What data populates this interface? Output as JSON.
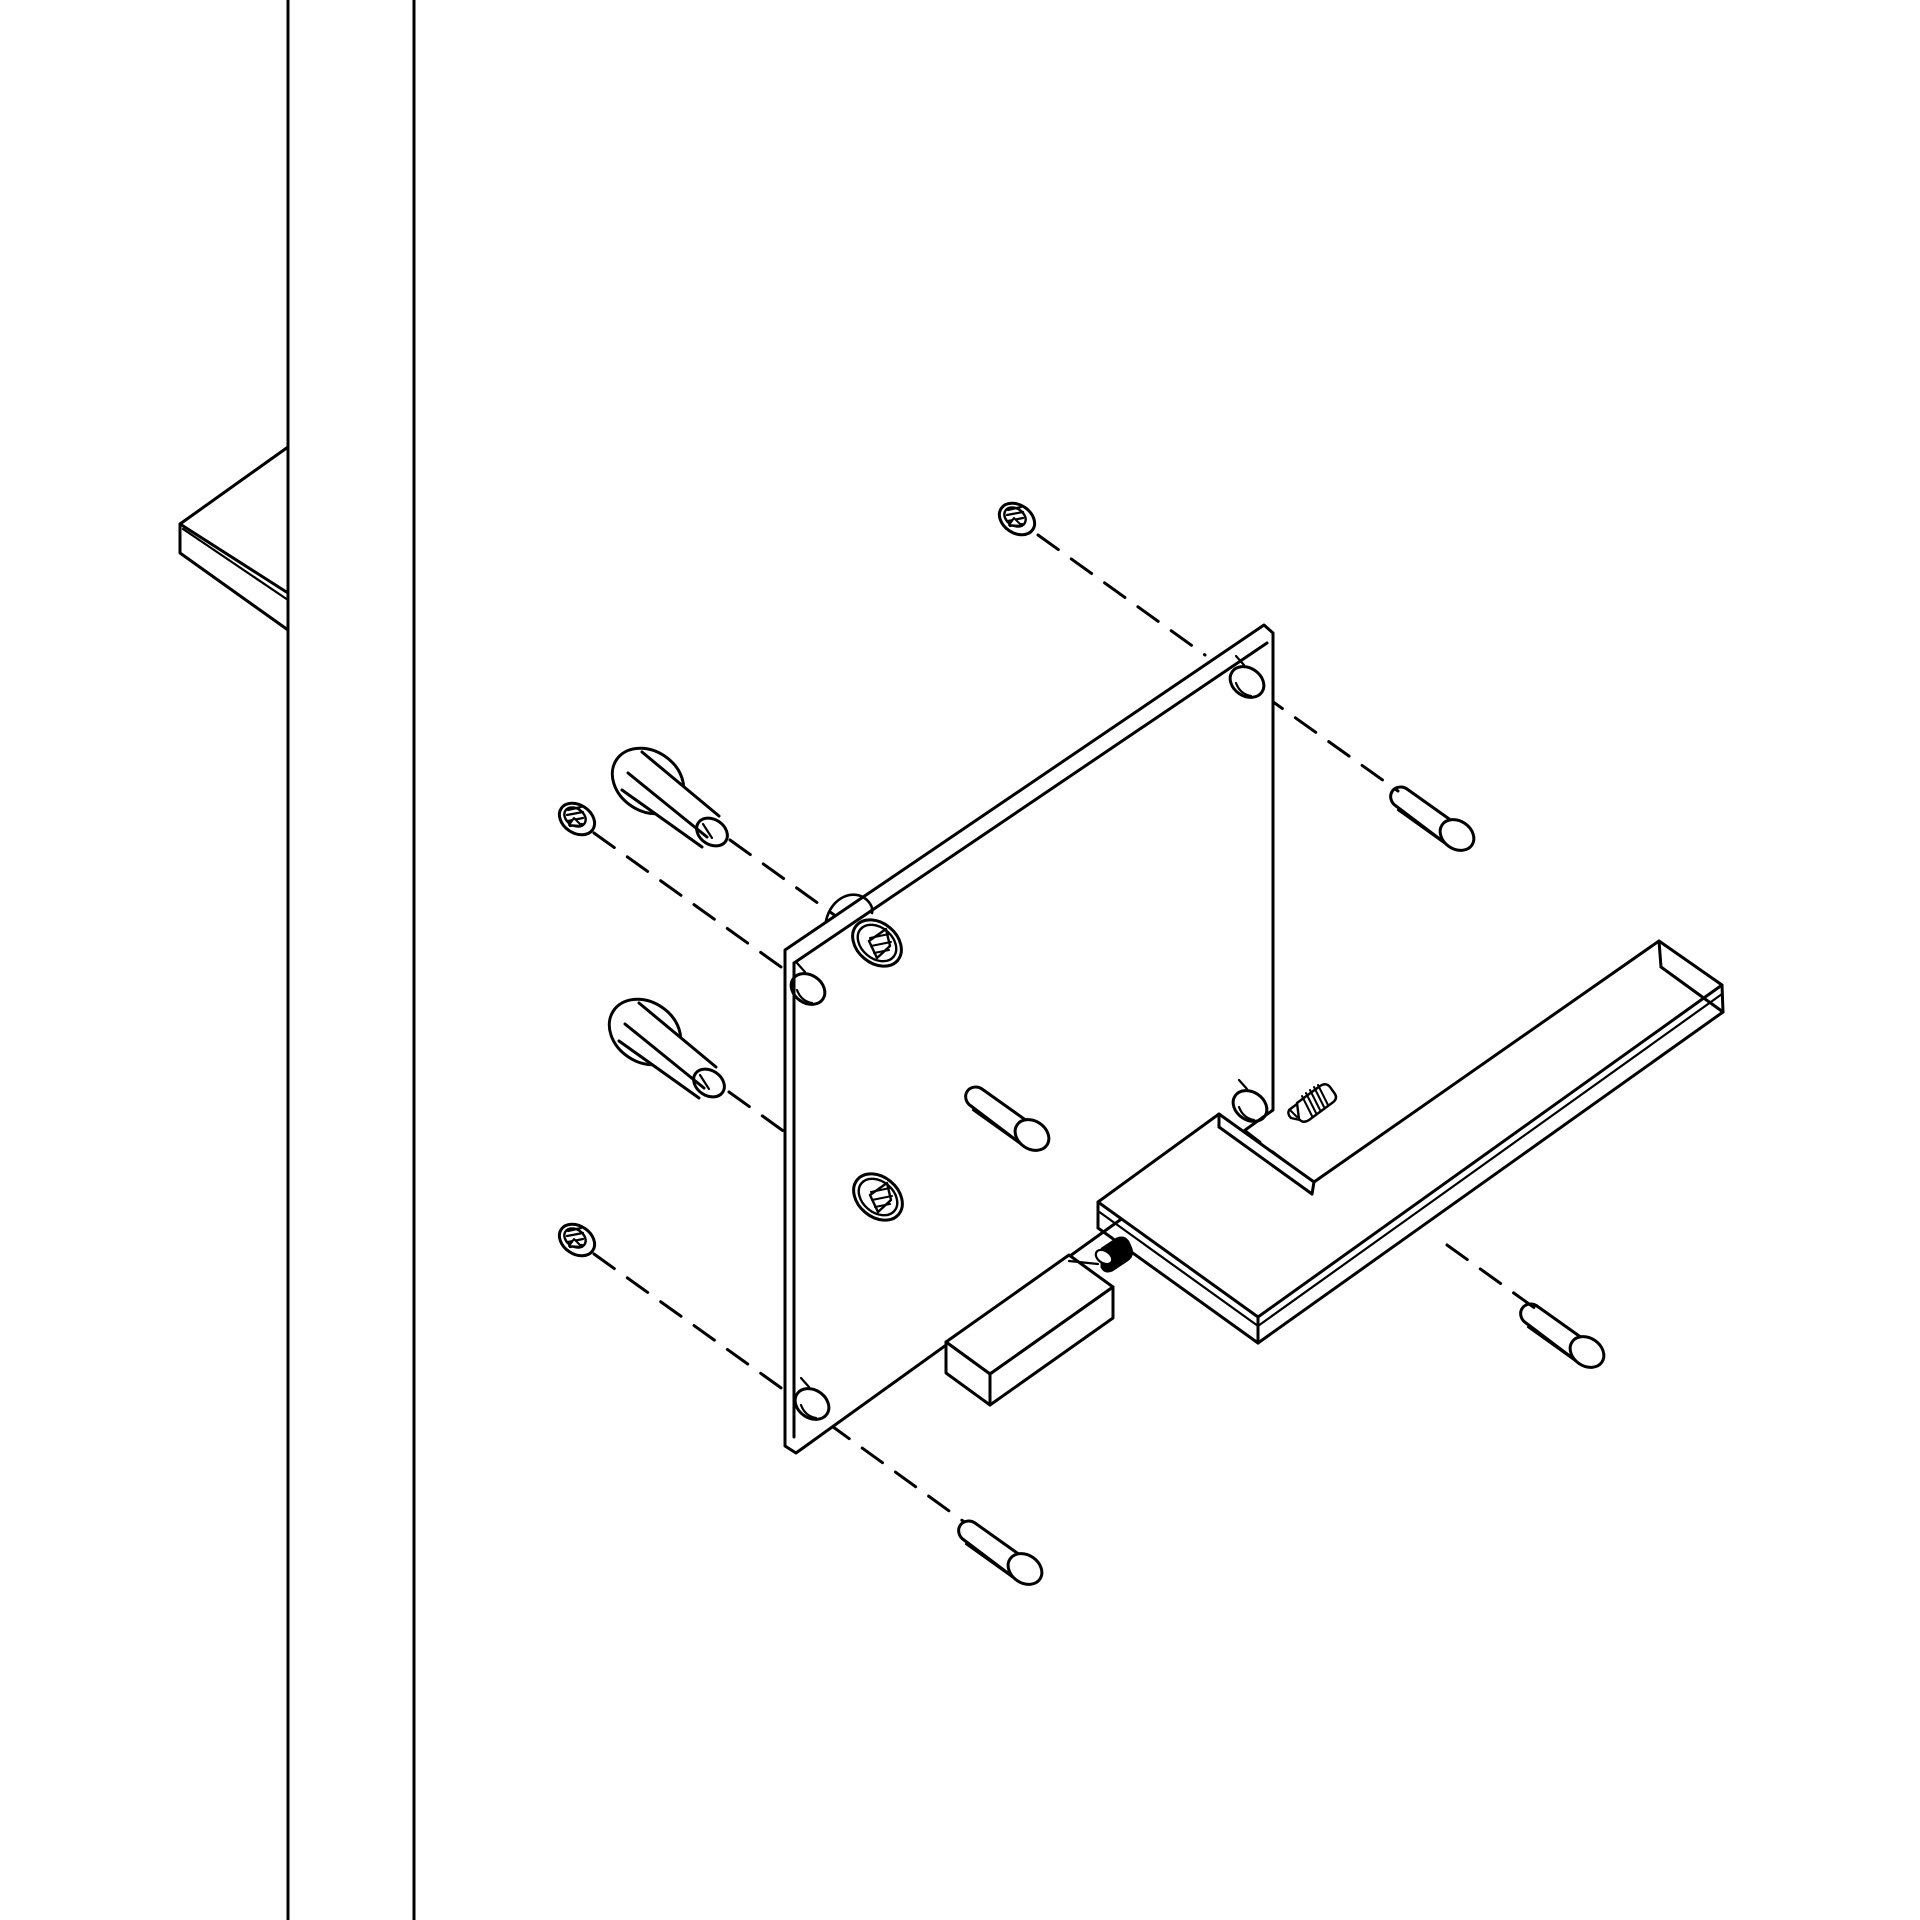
{
  "canvas": {
    "width": 1920,
    "height": 1920,
    "background_color": "#ffffff",
    "line_color": "#000000",
    "stroke_width": 3,
    "detail_stroke_width": 2.4,
    "dash_pattern": "25 16"
  },
  "diagram": {
    "kind": "exploded-isometric-line-drawing",
    "subject": "door-lever-handle-mounting-kit"
  },
  "parts": [
    {
      "name": "door-edge",
      "items": [
        {
          "t": "p",
          "d": "M 288 0 L 288 1920"
        },
        {
          "t": "p",
          "d": "M 414 0 L 414 1920"
        }
      ]
    },
    {
      "name": "strike-plate-corner",
      "items": [
        {
          "t": "p",
          "d": "M 288 447 L 180 524 L 180 553 L 288 630"
        },
        {
          "t": "p",
          "d": "M 180 524 L 288 593"
        },
        {
          "t": "p",
          "d": "M 183 529 L 288 600",
          "w": 2.2
        }
      ]
    },
    {
      "name": "dashed-assembly-axes",
      "dashed": true,
      "items": [
        {
          "t": "p",
          "d": "M 1038 535 L 1205 655"
        },
        {
          "t": "p",
          "d": "M 1262 694 L 1398 791"
        },
        {
          "t": "p",
          "d": "M 730 840 L 858 932"
        },
        {
          "t": "p",
          "d": "M 594 833 L 795 977"
        },
        {
          "t": "p",
          "d": "M 824 1003 L 968 1107"
        },
        {
          "t": "p",
          "d": "M 729 1092 L 860 1186"
        },
        {
          "t": "p",
          "d": "M 896 1211 L 988 1277"
        },
        {
          "t": "p",
          "d": "M 594 1254 L 798 1400"
        },
        {
          "t": "p",
          "d": "M 829 1424 L 963 1521"
        },
        {
          "t": "p",
          "d": "M 1240 1127 L 1312 1182"
        },
        {
          "t": "p",
          "d": "M 1447 1245 L 1543 1314"
        },
        {
          "t": "p",
          "d": "M 1133 1111 L 1162 1133"
        }
      ]
    },
    {
      "name": "back-plate",
      "items": [
        {
          "t": "p",
          "d": "M 785 950 L 1264 625 L 1273 633 L 1273 1110 L 796 1453 L 785 1446 Z",
          "fill": "#ffffff"
        },
        {
          "t": "p",
          "d": "M 794 963 L 1267 643"
        },
        {
          "t": "p",
          "d": "M 794 963 L 794 1437"
        },
        {
          "t": "p",
          "d": "M 826 921 C 831 897 854 888 867 900 C 872 905 873 909 872 913",
          "w": 2.6
        }
      ]
    },
    {
      "name": "plate-corner-hole-top-left",
      "items": [
        {
          "t": "e",
          "cx": 808,
          "cy": 989,
          "rx": 14,
          "ry": 18,
          "rot": -56
        },
        {
          "t": "p",
          "d": "M 797 990 Q 801 1001 812 1003",
          "w": 2.2
        },
        {
          "t": "p",
          "d": "M 805 972 L 797 963",
          "w": 2.2
        }
      ]
    },
    {
      "name": "plate-corner-hole-top-right",
      "items": [
        {
          "t": "e",
          "cx": 1247,
          "cy": 682,
          "rx": 14,
          "ry": 18,
          "rot": -56
        },
        {
          "t": "p",
          "d": "M 1236 683 Q 1240 694 1251 696",
          "w": 2.2
        },
        {
          "t": "p",
          "d": "M 1244 665 L 1236 656",
          "w": 2.2
        }
      ]
    },
    {
      "name": "plate-corner-hole-bottom-left",
      "items": [
        {
          "t": "e",
          "cx": 812,
          "cy": 1404,
          "rx": 14,
          "ry": 18,
          "rot": -56
        },
        {
          "t": "p",
          "d": "M 801 1405 Q 805 1416 816 1418",
          "w": 2.2
        },
        {
          "t": "p",
          "d": "M 809 1387 L 801 1378",
          "w": 2.2
        }
      ]
    },
    {
      "name": "plate-corner-hole-bottom-right",
      "items": [
        {
          "t": "e",
          "cx": 1250,
          "cy": 1106,
          "rx": 14,
          "ry": 18,
          "rot": -56
        },
        {
          "t": "p",
          "d": "M 1239 1107 Q 1243 1118 1254 1120",
          "w": 2.2
        },
        {
          "t": "p",
          "d": "M 1247 1089 L 1239 1080",
          "w": 2.2
        }
      ]
    },
    {
      "name": "plate-square-socket-upper",
      "items": [
        {
          "t": "e",
          "cx": 877,
          "cy": 943,
          "rx": 20,
          "ry": 27,
          "rot": -50
        },
        {
          "t": "e",
          "cx": 877,
          "cy": 943,
          "rx": 15.5,
          "ry": 21.5,
          "rot": -50,
          "w": 2.4
        },
        {
          "t": "p",
          "d": "M 886 929 L 869 941 L 877 958 L 890 946 Z",
          "w": 2.4
        },
        {
          "t": "p",
          "d": "M 870 938 L 889 934",
          "w": 2
        },
        {
          "t": "p",
          "d": "M 871 946 L 891 942",
          "w": 2
        },
        {
          "t": "p",
          "d": "M 874 953 L 889 950",
          "w": 2
        }
      ]
    },
    {
      "name": "plate-square-socket-lower",
      "items": [
        {
          "t": "e",
          "cx": 878,
          "cy": 1197,
          "rx": 20,
          "ry": 27,
          "rot": -50
        },
        {
          "t": "e",
          "cx": 878,
          "cy": 1197,
          "rx": 15.5,
          "ry": 21.5,
          "rot": -50,
          "w": 2.4
        },
        {
          "t": "p",
          "d": "M 887 1183 L 870 1195 L 878 1212 L 891 1200 Z",
          "w": 2.4
        },
        {
          "t": "p",
          "d": "M 871 1192 L 890 1188",
          "w": 2
        },
        {
          "t": "p",
          "d": "M 872 1200 L 892 1196",
          "w": 2
        },
        {
          "t": "p",
          "d": "M 875 1207 L 890 1204",
          "w": 2
        }
      ]
    },
    {
      "name": "flat-head-screw-top",
      "items": [
        {
          "t": "e",
          "cx": 1017,
          "cy": 519,
          "rx": 14,
          "ry": 19,
          "rot": -56,
          "fill": "#ffffff"
        },
        {
          "t": "e",
          "cx": 1015,
          "cy": 517,
          "rx": 8.5,
          "ry": 11.5,
          "rot": -56,
          "w": 2.4
        },
        {
          "t": "p",
          "d": "M 1008 510 L 1021 507",
          "w": 2.2
        },
        {
          "t": "p",
          "d": "M 1007 515 L 1023 512",
          "w": 2.2
        },
        {
          "t": "p",
          "d": "M 1008 521 L 1023 518",
          "w": 2.2
        },
        {
          "t": "p",
          "d": "M 1010 526 L 1022 524",
          "w": 2.2
        },
        {
          "t": "p",
          "d": "M 1014 518 L 1022 526 L 1009 525 Z",
          "fill": "#ffffff",
          "w": 2
        }
      ]
    },
    {
      "name": "flat-head-screw-left-upper",
      "items": [
        {
          "t": "e",
          "cx": 577,
          "cy": 819,
          "rx": 14,
          "ry": 19,
          "rot": -56,
          "fill": "#ffffff"
        },
        {
          "t": "e",
          "cx": 575,
          "cy": 817,
          "rx": 8.5,
          "ry": 11.5,
          "rot": -56,
          "w": 2.4
        },
        {
          "t": "p",
          "d": "M 568 810 L 581 807",
          "w": 2.2
        },
        {
          "t": "p",
          "d": "M 567 815 L 583 812",
          "w": 2.2
        },
        {
          "t": "p",
          "d": "M 568 821 L 583 818",
          "w": 2.2
        },
        {
          "t": "p",
          "d": "M 570 826 L 582 824",
          "w": 2.2
        },
        {
          "t": "p",
          "d": "M 574 818 L 582 826 L 569 825 Z",
          "fill": "#ffffff",
          "w": 2
        }
      ]
    },
    {
      "name": "flat-head-screw-left-lower",
      "items": [
        {
          "t": "e",
          "cx": 577,
          "cy": 1240,
          "rx": 14,
          "ry": 19,
          "rot": -56,
          "fill": "#ffffff"
        },
        {
          "t": "e",
          "cx": 575,
          "cy": 1238,
          "rx": 8.5,
          "ry": 11.5,
          "rot": -56,
          "w": 2.4
        },
        {
          "t": "p",
          "d": "M 568 1231 L 581 1228",
          "w": 2.2
        },
        {
          "t": "p",
          "d": "M 567 1236 L 583 1233",
          "w": 2.2
        },
        {
          "t": "p",
          "d": "M 568 1242 L 583 1239",
          "w": 2.2
        },
        {
          "t": "p",
          "d": "M 570 1247 L 582 1245",
          "w": 2.2
        },
        {
          "t": "p",
          "d": "M 574 1239 L 582 1247 L 569 1246 Z",
          "fill": "#ffffff",
          "w": 2
        }
      ]
    },
    {
      "name": "connecting-bolt-upper",
      "items": [
        {
          "t": "e",
          "cx": 648,
          "cy": 781,
          "rx": 30,
          "ry": 38,
          "rot": -56
        },
        {
          "t": "p",
          "d": "M 642 752 L 720 816 L 703 848 L 621 792 Z",
          "fill": "#ffffff",
          "w": 0
        },
        {
          "t": "p",
          "d": "M 642 752 L 719 816"
        },
        {
          "t": "p",
          "d": "M 628 773 L 707 837"
        },
        {
          "t": "p",
          "d": "M 622 790 L 702 847"
        },
        {
          "t": "e",
          "cx": 712,
          "cy": 832,
          "rx": 12.5,
          "ry": 16.5,
          "rot": -56
        },
        {
          "t": "p",
          "d": "M 703 824 L 712 838",
          "w": 2.2
        }
      ]
    },
    {
      "name": "connecting-bolt-lower",
      "items": [
        {
          "t": "e",
          "cx": 645,
          "cy": 1032,
          "rx": 30,
          "ry": 38,
          "rot": -56
        },
        {
          "t": "p",
          "d": "M 639 1003 L 717 1067 L 700 1099 L 618 1043 Z",
          "fill": "#ffffff",
          "w": 0
        },
        {
          "t": "p",
          "d": "M 639 1003 L 716 1067"
        },
        {
          "t": "p",
          "d": "M 625 1024 L 704 1088"
        },
        {
          "t": "p",
          "d": "M 619 1041 L 699 1098"
        },
        {
          "t": "e",
          "cx": 709,
          "cy": 1083,
          "rx": 12.5,
          "ry": 16.5,
          "rot": -56
        },
        {
          "t": "p",
          "d": "M 700 1075 L 709 1089",
          "w": 2.2
        }
      ]
    },
    {
      "name": "sleeve-nut-pin-top",
      "items": [
        {
          "t": "p",
          "d": "M 1407 789 A 10 11 -56 1 0 1396 806"
        },
        {
          "t": "p",
          "d": "M 1407 789 L 1452 821"
        },
        {
          "t": "p",
          "d": "M 1396 806 L 1445 843"
        },
        {
          "t": "p",
          "d": "M 1398 810 L 1447 845",
          "w": 2.2
        },
        {
          "t": "e",
          "cx": 1457,
          "cy": 835,
          "rx": 14,
          "ry": 18,
          "rot": -56,
          "fill": "#ffffff"
        }
      ]
    },
    {
      "name": "sleeve-nut-pin-middle",
      "items": [
        {
          "t": "p",
          "d": "M 982 1089 A 10 11 -56 1 0 971 1106"
        },
        {
          "t": "p",
          "d": "M 982 1089 L 1027 1121"
        },
        {
          "t": "p",
          "d": "M 971 1106 L 1020 1143"
        },
        {
          "t": "p",
          "d": "M 973 1110 L 1022 1145",
          "w": 2.2
        },
        {
          "t": "e",
          "cx": 1032,
          "cy": 1135,
          "rx": 14,
          "ry": 18,
          "rot": -56,
          "fill": "#ffffff"
        }
      ]
    },
    {
      "name": "sleeve-nut-pin-right",
      "items": [
        {
          "t": "p",
          "d": "M 1537 1306 A 10 11 -56 1 0 1526 1323"
        },
        {
          "t": "p",
          "d": "M 1537 1306 L 1582 1338"
        },
        {
          "t": "p",
          "d": "M 1526 1323 L 1575 1360"
        },
        {
          "t": "p",
          "d": "M 1528 1327 L 1577 1362",
          "w": 2.2
        },
        {
          "t": "e",
          "cx": 1587,
          "cy": 1352,
          "rx": 14,
          "ry": 18,
          "rot": -56,
          "fill": "#ffffff"
        }
      ]
    },
    {
      "name": "sleeve-nut-pin-bottom",
      "items": [
        {
          "t": "p",
          "d": "M 975 1523 A 10 11 -56 1 0 964 1540"
        },
        {
          "t": "p",
          "d": "M 975 1523 L 1020 1555"
        },
        {
          "t": "p",
          "d": "M 964 1540 L 1013 1577"
        },
        {
          "t": "p",
          "d": "M 966 1544 L 1015 1579",
          "w": 2.2
        },
        {
          "t": "e",
          "cx": 1025,
          "cy": 1569,
          "rx": 14,
          "ry": 18,
          "rot": -56,
          "fill": "#ffffff"
        }
      ]
    },
    {
      "name": "spindle",
      "items": [
        {
          "t": "p",
          "d": "M 946 1342 L 1069 1255 L 1113 1287 L 990 1374 Z",
          "fill": "#ffffff"
        },
        {
          "t": "p",
          "d": "M 990 1374 L 1113 1287 L 1113 1318 L 990 1405 Z",
          "fill": "#ffffff"
        },
        {
          "t": "p",
          "d": "M 946 1342 L 990 1374 L 990 1405 L 946 1373 Z",
          "fill": "#ffffff"
        }
      ]
    },
    {
      "name": "spindle-set-screw",
      "items": [
        {
          "t": "p",
          "d": "M 1069 1261 L 1098 1264",
          "w": 2.2
        },
        {
          "t": "p",
          "d": "M 1102 1249 L 1117 1239 Q 1124 1236 1128 1242 L 1131 1249 Q 1133 1256 1127 1260 L 1112 1270 Q 1105 1273 1102 1267 Z",
          "fill": "#000000"
        },
        {
          "t": "e",
          "cx": 1104,
          "cy": 1257,
          "rx": 6,
          "ry": 9,
          "rot": -56,
          "fill": "#ffffff",
          "w": 2.2
        }
      ]
    },
    {
      "name": "lever-handle",
      "items": [
        {
          "t": "p",
          "d": "M 1098 1202 L 1219 1114 L 1314 1182 L 1659 941 L 1722 985 L 1258 1317 Z",
          "fill": "#ffffff"
        },
        {
          "t": "p",
          "d": "M 1098 1202 L 1098 1228"
        },
        {
          "t": "p",
          "d": "M 1258 1317 L 1258 1343"
        },
        {
          "t": "p",
          "d": "M 1098 1228 L 1258 1343"
        },
        {
          "t": "p",
          "d": "M 1098 1211 L 1258 1326",
          "w": 2.2
        },
        {
          "t": "p",
          "d": "M 1258 1343 L 1723 1012"
        },
        {
          "t": "p",
          "d": "M 1258 1326 L 1722 994",
          "w": 2.2
        },
        {
          "t": "p",
          "d": "M 1722 985 L 1723 1012"
        },
        {
          "t": "p",
          "d": "M 1659 941 L 1661 967"
        },
        {
          "t": "p",
          "d": "M 1661 967 L 1723 1012"
        },
        {
          "t": "p",
          "d": "M 1219 1114 L 1219 1127"
        },
        {
          "t": "p",
          "d": "M 1219 1127 L 1312 1194"
        },
        {
          "t": "p",
          "d": "M 1312 1194 L 1314 1182"
        }
      ]
    },
    {
      "name": "lever-grub-screw",
      "items": [
        {
          "t": "p",
          "d": "M 1297 1103 L 1320 1086 Q 1326 1082 1330 1087 L 1335 1094 Q 1338 1099 1332 1103 L 1309 1120 Q 1303 1124 1299 1119 Z",
          "fill": "#ffffff",
          "w": 2.4
        },
        {
          "t": "p",
          "d": "M 1297 1104 L 1289 1110 Q 1287 1114 1291 1118 L 1300 1120",
          "w": 2.4
        },
        {
          "t": "p",
          "d": "M 1290 1110 L 1297 1117",
          "w": 2
        },
        {
          "t": "p",
          "d": "M 1302 1096 L 1312 1116",
          "w": 2
        },
        {
          "t": "p",
          "d": "M 1306 1093 L 1316 1113",
          "w": 2
        },
        {
          "t": "p",
          "d": "M 1310 1090 L 1320 1110",
          "w": 2
        },
        {
          "t": "p",
          "d": "M 1314 1087 L 1324 1107",
          "w": 2
        },
        {
          "t": "p",
          "d": "M 1318 1085 L 1328 1105",
          "w": 2
        }
      ]
    }
  ]
}
